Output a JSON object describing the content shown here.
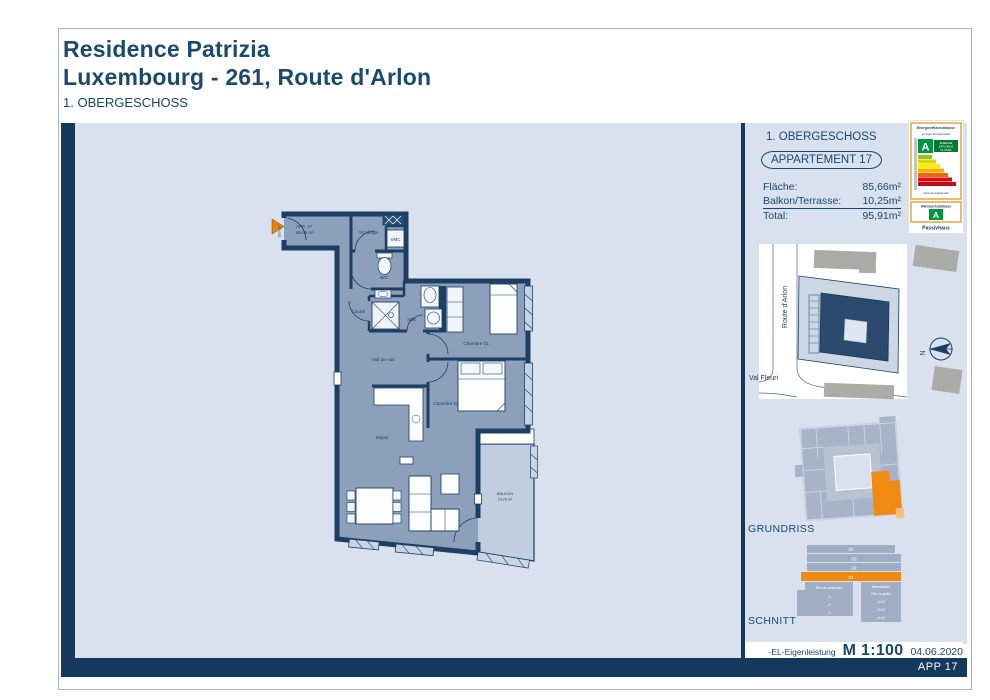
{
  "header": {
    "title_line1": "Residence Patrizia",
    "title_line2": "Luxembourg - 261, Route d'Arlon",
    "floor": "1. OBERGESCHOSS"
  },
  "plan": {
    "entry": {
      "app": "APP. 17",
      "area": "85.66 m²",
      "door_code": "E03-S17"
    },
    "rooms": {
      "stockage": "Stockage",
      "vmc": "VMC",
      "wc": "WC",
      "couloir": "Couloir",
      "sdb": "SDB",
      "hall": "Hall de nuit",
      "chambre1": "Chambre 01",
      "chambre2": "Chambre 02",
      "sejour": "Séjour",
      "balkon": "BALKON",
      "balkon_area": "10,25 m²"
    }
  },
  "sidebar": {
    "floor_label": "1. OBERGESCHOSS",
    "apartment_badge": "APPARTEMENT 17",
    "areas": [
      {
        "label": "Fläche:",
        "value": "85,66m²"
      },
      {
        "label": "Balkon/Terrasse:",
        "value": "10,25m²"
      },
      {
        "label": "Total:",
        "value": "95,91m²"
      }
    ],
    "site": {
      "street_left": "Route d'Arlon",
      "street_bottom": "Val Fleuri",
      "north": "N"
    },
    "grundriss_label": "GRUNDRISS",
    "schnitt_label": "SCHNITT",
    "schnitt": {
      "floors": [
        "04",
        "03",
        "02",
        "01"
      ],
      "left": [
        "Rez-de-chaussée",
        "-1",
        "-2",
        "-3"
      ],
      "right": [
        "Intermédiaire",
        "Rez-de-jardin",
        "-1 1/2",
        "-2 1/2",
        "-3 1/2"
      ]
    }
  },
  "energy": {
    "box1_title": "Energieeffizienzklasse",
    "low": "geringer Energiebedarf",
    "high": "hoher Energiebedarf",
    "letter": "A",
    "klasse_l1": "ENERGIE",
    "klasse_l2": "EFFIZIENZ",
    "klasse_l3": "KLASSE",
    "box2_title": "Wärmeschutzklasse",
    "letter2": "A",
    "footer": "Passivhaus"
  },
  "footer": {
    "note": "-EL-Eigenleistung",
    "scale": "M 1:100",
    "date": "04.06.2020",
    "sheet": "APP 17"
  },
  "colors": {
    "navy": "#14395C",
    "accent_orange": "#F08A12",
    "plan_bg": "#DAE1EE",
    "apartment_fill": "#8CA0BC",
    "balcony_fill": "#C1CEDF",
    "energy_green": "#009641"
  }
}
